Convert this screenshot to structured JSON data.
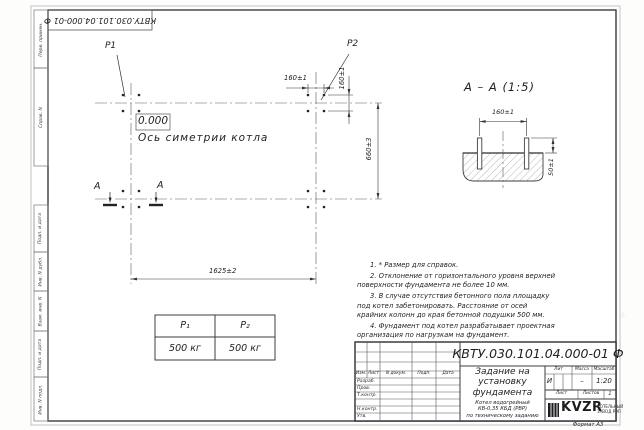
{
  "watermark": {
    "text": "kotel-kv.ru"
  },
  "stamp": {
    "corner_doc_number": "КВТУ.030.101.04.000-01  Ф"
  },
  "margin": {
    "labels": [
      "Перв. примен.",
      "Справ. N",
      "Подп. и дата",
      "Инв. N дубл.",
      "Взам. инв. N",
      "Подп. и дата",
      "Инв. N подл."
    ]
  },
  "plan": {
    "p1_label": "P1",
    "p2_label": "P2",
    "elevation": "0.000",
    "axis_label": "Ось симетрии котла",
    "dim_160_top": "160±1",
    "dim_160_side": "160±1",
    "dim_660": "660±3",
    "dim_1625": "1625±2",
    "section_letter_left": "А",
    "section_letter_right": "А"
  },
  "section_view": {
    "title": "А – А (1:5)",
    "dim_160": "160±1",
    "dim_50": "50±1"
  },
  "load_table": {
    "col1_header": "P₁",
    "col2_header": "P₂",
    "col1_value": "500 кг",
    "col2_value": "500 кг"
  },
  "notes": {
    "items": [
      "1. * Размер для справок.",
      "2. Отклонение от горизонтального уровня верхней поверхности фундамента не более 10 мм.",
      "3. В случае отсутствия бетонного пола площадку под котел забетонировать. Расстояние от осей крайних колонн до края бетонной подушки 500 мм.",
      "4. Фундамент под котел разрабатывает проектная организация по нагрузкам на фундамент."
    ]
  },
  "title_block": {
    "doc_number": "КВТУ.030.101.04.000-01  Ф",
    "title": "Задание на\nустановку\nфундамента",
    "subtitle": "Котел водогрейный\nКВ-0,35 КБД (РВР)\nпо техническому заданию",
    "header": {
      "izm": "Изм.",
      "list": "Лист",
      "docnum": "N докум.",
      "podp": "Подп.",
      "data": "Дата"
    },
    "rows": [
      "Разраб.",
      "Пров.",
      "Т.контр.",
      "Н.контр.",
      "Утв."
    ],
    "lit_header": "Лит",
    "mass_header": "Масса",
    "scale_header": "Масштаб",
    "lit_value": "И",
    "mass_value": "–",
    "scale_value": "1:20",
    "sheet_label": "Лист",
    "sheets_label": "Листов",
    "sheets_value": "1",
    "logo_text": "KVZR",
    "logo_caption": "КОТЕЛЬНЫЙ\nЗАВОД РЭП",
    "format_label": "Формат А3"
  }
}
